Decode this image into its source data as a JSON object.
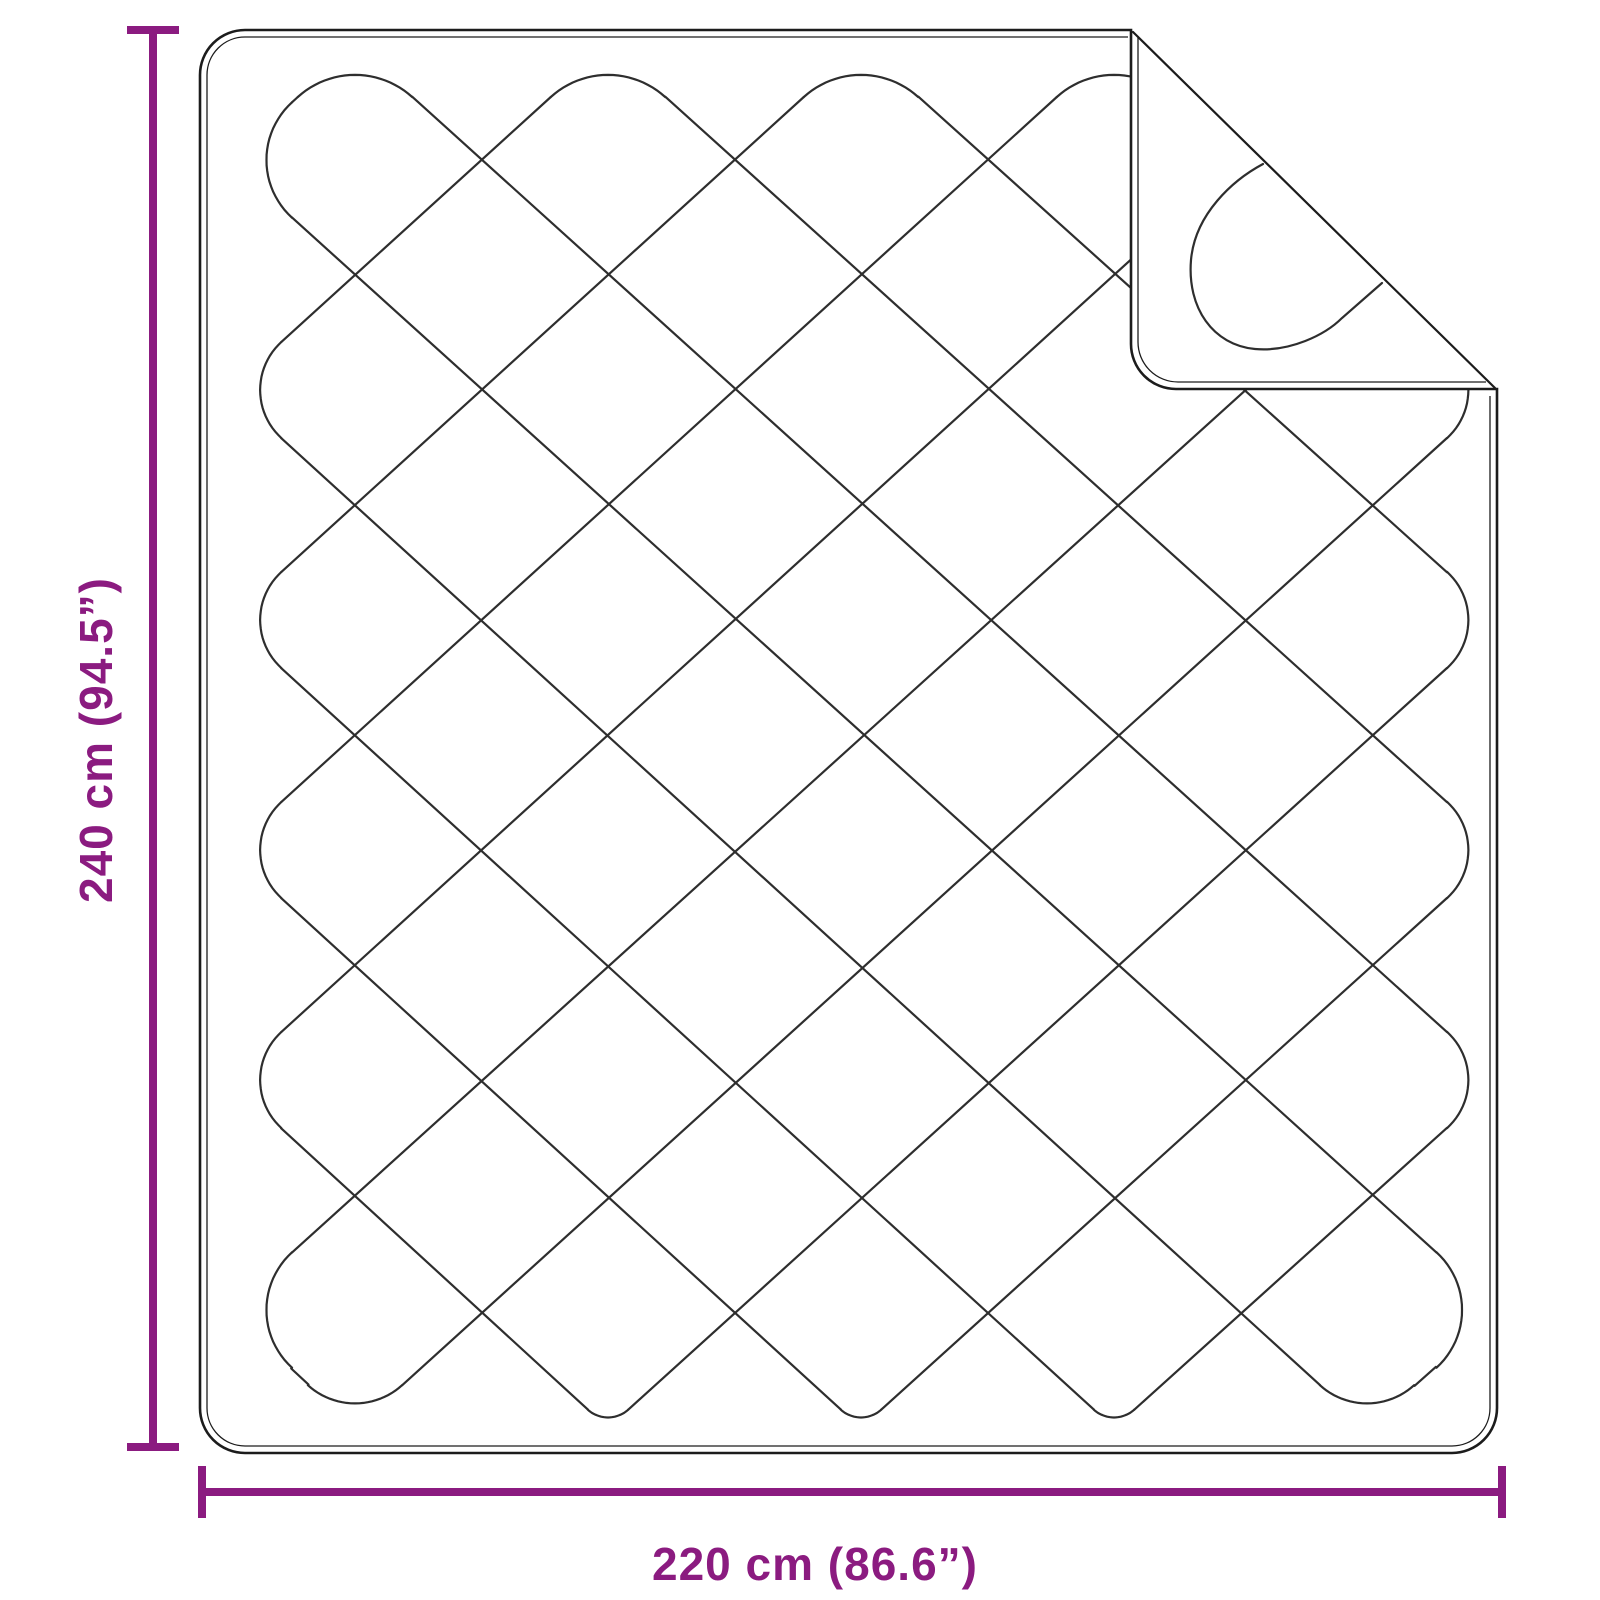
{
  "diagram": {
    "subject": "quilted-blanket-with-folded-corner",
    "height_label": "240 cm (94.5”)",
    "width_label": "220 cm (86.6”)"
  },
  "colors": {
    "dimension": "#8B1B80",
    "outline": "#1c1c1c",
    "stitch": "#2e2e2e",
    "background": "#ffffff"
  }
}
